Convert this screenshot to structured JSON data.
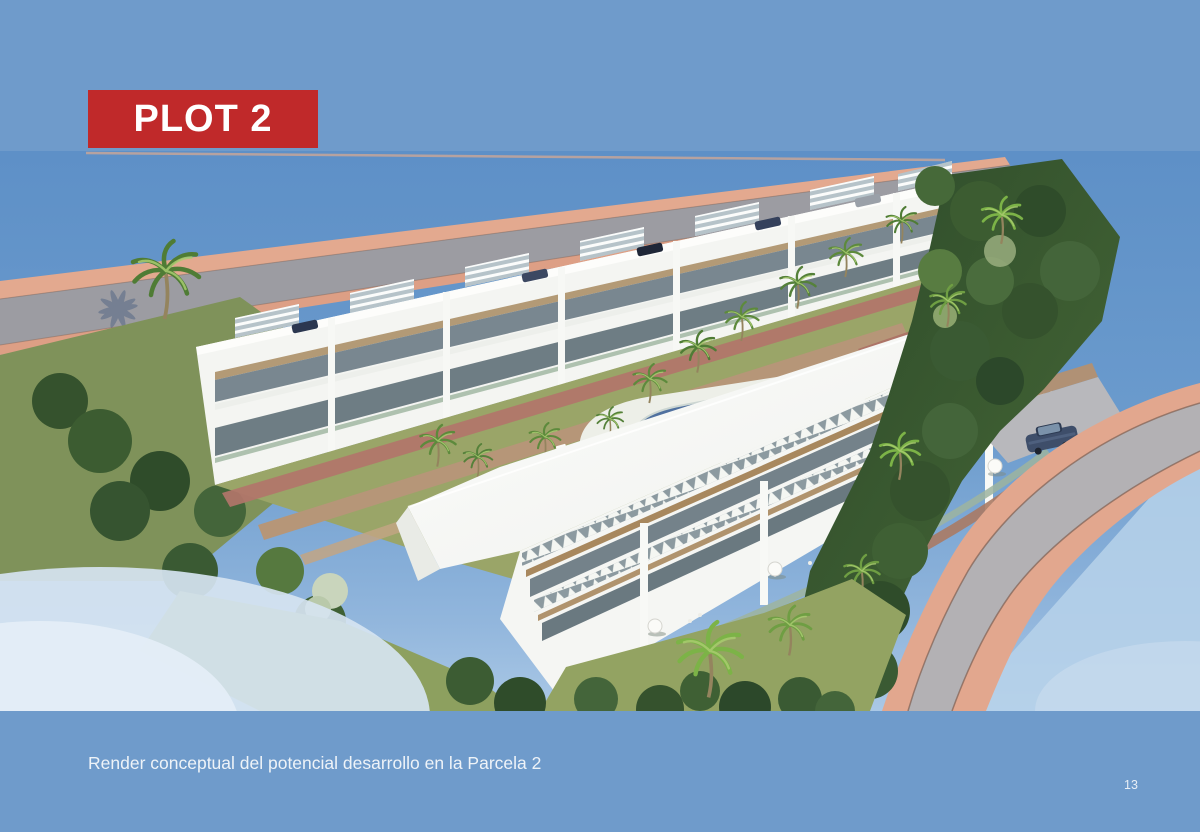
{
  "slide": {
    "background_color": "#6f9bcb",
    "page_number": "13"
  },
  "banner": {
    "label": "PLOT 2",
    "background_color": "#c0292a",
    "text_color": "#ffffff"
  },
  "caption": {
    "text": "Render conceptual del potencial desarrollo en la Parcela 2"
  },
  "render": {
    "alt": "Aerial concept render of two rows of white townhouses with rooftop pergolas, communal pool, palm trees, gardens and perimeter roads"
  }
}
